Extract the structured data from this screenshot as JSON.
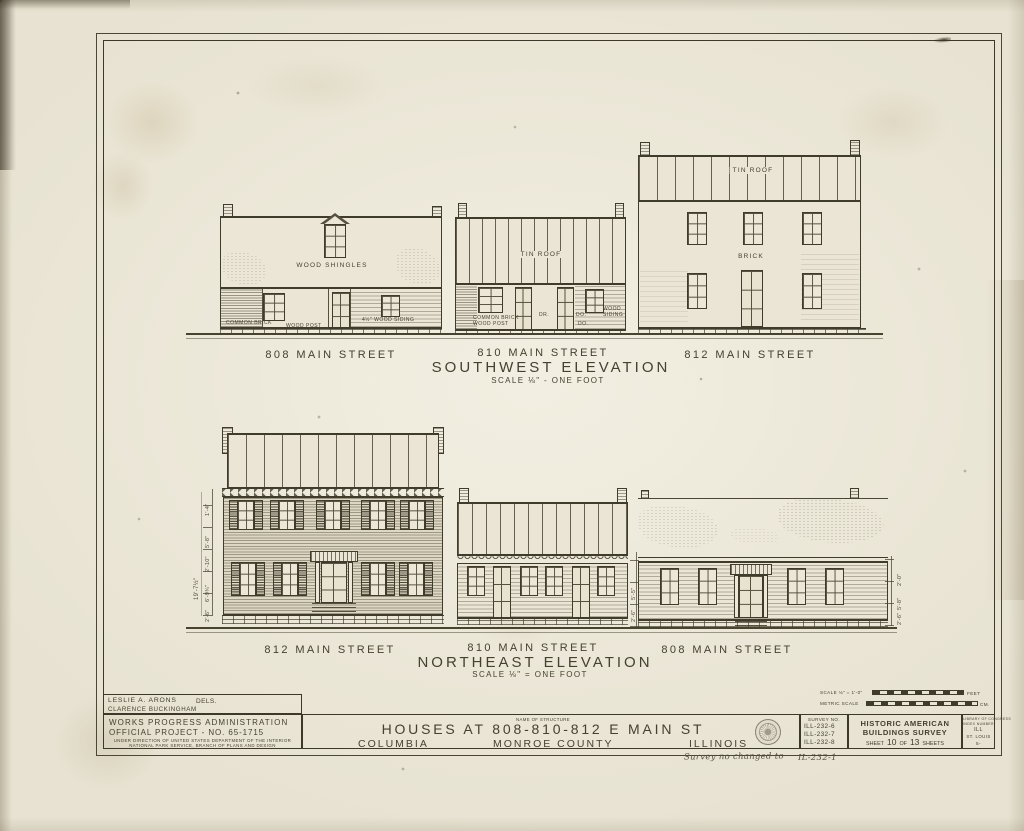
{
  "colors": {
    "paper": "#e7e2d1",
    "ink": "#403c2c"
  },
  "sw": {
    "label_left": "808 MAIN STREET",
    "label_mid": "810 MAIN STREET",
    "label_right": "812 MAIN STREET",
    "title": "SOUTHWEST ELEVATION",
    "scale": "SCALE ⅛\" - ONE FOOT",
    "wood_shingles": "WOOD SHINGLES",
    "tin_roof_mid": "TIN ROOF",
    "tin_roof_right": "TIN ROOF",
    "brick": "BRICK",
    "common_brick_left": "COMMON BRICK",
    "wood_post_left": "WOOD POST",
    "wood_siding_left": "4½\" WOOD SIDING",
    "common_brick_mid": "COMMON BRICK",
    "wood_post_mid": "WOOD POST",
    "wood_mid": "WOOD",
    "siding_mid": "SIDING",
    "dr": "DR.",
    "do1": "DO.",
    "do2": "DO."
  },
  "ne": {
    "label_left": "812 MAIN STREET",
    "label_mid": "810 MAIN STREET",
    "label_right": "808 MAIN STREET",
    "title": "NORTHEAST ELEVATION",
    "scale": "SCALE ⅛\" = ONE FOOT",
    "dims_left": [
      "1'-4\"",
      "5'-8\"",
      "2'-10\"",
      "6'-9¾\"",
      "2'-6\"",
      "19'-7½\""
    ],
    "dims_mid": [
      "5'-5\"",
      "2'-6\""
    ],
    "dims_right": [
      "2'-0\"",
      "5'-8\"",
      "2'-6\""
    ]
  },
  "tb": {
    "del1": "LESLIE A. ARONS",
    "del2": "CLARENCE BUCKINGHAM",
    "dels": "DELS.",
    "wpa1": "WORKS PROGRESS ADMINISTRATION",
    "wpa2": "OFFICIAL PROJECT - NO. 65-1715",
    "wpa3": "UNDER DIRECTION OF UNITED STATES DEPARTMENT OF THE INTERIOR",
    "wpa4": "NATIONAL PARK SERVICE, BRANCH OF PLANS AND DESIGN",
    "nos_label": "NAME OF STRUCTURE",
    "structure": "HOUSES AT 808-810-812 E MAIN ST",
    "city": "COLUMBIA",
    "county": "MONROE COUNTY",
    "state": "ILLINOIS",
    "survey_label": "SURVEY NO.",
    "survey": [
      "ILL-232-6",
      "ILL-232-7",
      "ILL-232-8"
    ],
    "habs1": "HISTORIC AMERICAN",
    "habs2": "BUILDINGS SURVEY",
    "sheet_word1": "SHEET",
    "sheet_no": "10",
    "sheet_of": "OF",
    "sheet_total": "13",
    "sheet_word2": "SHEETS",
    "idx1": "LIBRARY OF CONGRESS",
    "idx2": "INDEX NUMBER",
    "idx3": "ILL",
    "idx4": "ST. LOUIS",
    "idx5": "5-",
    "scale_label": "SCALE ⅛\" = 1'-0\"",
    "feet": "FEET",
    "metric_label": "METRIC SCALE",
    "cm": "CM."
  },
  "hand": {
    "note": "Survey no changed to",
    "num": "IL-232-1"
  }
}
